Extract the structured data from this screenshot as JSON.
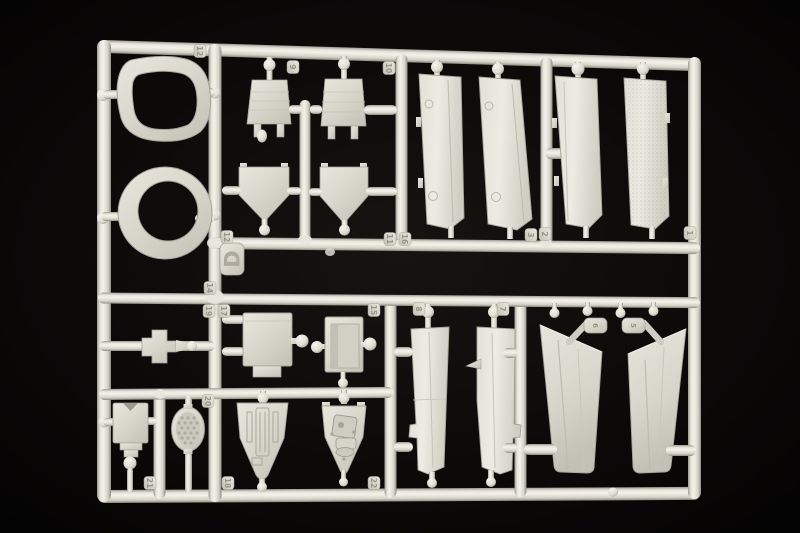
{
  "scene": {
    "type": "product-photograph",
    "subject": "Injection-molded polystyrene model aircraft kit sprue (runner frame) with unassembled parts, light warm-grey plastic photographed on a black background",
    "background_color": "#050403",
    "plastic_base_color": "#d9d6cc",
    "plastic_highlight_color": "#f3f1e9",
    "plastic_shadow_color": "#9b988c"
  },
  "sprue": {
    "letter": "D",
    "tags": [
      "12",
      "12",
      "9",
      "10",
      "14",
      "19",
      "17",
      "20",
      "21",
      "18",
      "22",
      "15",
      "8",
      "7",
      "11",
      "16",
      "3",
      "2",
      "1"
    ],
    "bracket_labels": [
      "6",
      "5"
    ]
  },
  "parts": [
    {
      "name": "windscreen-frame",
      "description": "rounded rectangular canopy frame ring, top left"
    },
    {
      "name": "canopy-ring",
      "description": "oval ring with round opening, left"
    },
    {
      "name": "bulkhead-panel-left",
      "description": "trapezoid bulkhead with two legs and ball gate"
    },
    {
      "name": "bulkhead-panel-right",
      "description": "trapezoid bulkhead with two legs"
    },
    {
      "name": "shield-panel-left",
      "description": "pentagon rear deck panel, point down"
    },
    {
      "name": "shield-panel-right",
      "description": "pentagon rear deck panel, point down"
    },
    {
      "name": "fuselage-panel-1",
      "description": "long flat panel with ejector marks"
    },
    {
      "name": "fuselage-panel-2",
      "description": "long flat panel, slanted"
    },
    {
      "name": "fuselage-panel-3",
      "description": "long flat panel"
    },
    {
      "name": "fuselage-panel-4",
      "description": "long flat panel, textured"
    },
    {
      "name": "cross-mount",
      "description": "small stepped cross-shaped mount on runner"
    },
    {
      "name": "equipment-box",
      "description": "rectangular box plate with lower tab"
    },
    {
      "name": "access-door-panel",
      "description": "box plate with recessed door"
    },
    {
      "name": "cockpit-tub",
      "description": "triangular ribbed cockpit floor, point down"
    },
    {
      "name": "gear-bay-tub",
      "description": "triangular bay with raised mechanism, point down"
    },
    {
      "name": "seat-back",
      "description": "notched rectangular seat part with ball gate"
    },
    {
      "name": "mesh-grille",
      "description": "oval grille with honeycomb mesh"
    },
    {
      "name": "flap-panel-left",
      "description": "tapered vertical flap with side notch"
    },
    {
      "name": "flap-panel-right",
      "description": "tapered vertical flap with side notch"
    },
    {
      "name": "wing-slat-left",
      "description": "large slanted blade panel"
    },
    {
      "name": "wing-slat-right",
      "description": "large slanted blade panel, mirrored"
    },
    {
      "name": "actuator-bracket-1",
      "description": "small numbered bracket with angled pin"
    },
    {
      "name": "actuator-bracket-2",
      "description": "small numbered bracket with angled pin"
    }
  ]
}
